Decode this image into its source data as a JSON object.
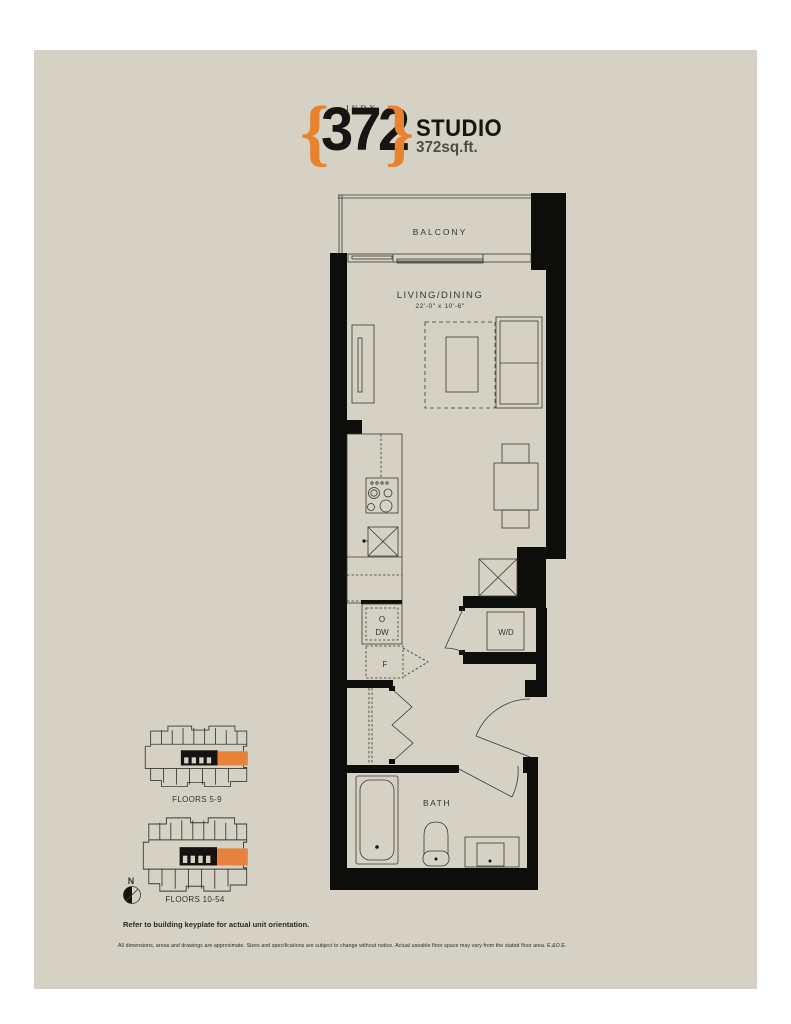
{
  "header": {
    "index_label": "INDX",
    "brace_left": "{",
    "brace_right": "}",
    "unit_number": "372",
    "unit_type": "STUDIO",
    "unit_area": "372sq.ft."
  },
  "floorplan": {
    "balcony_label": "BALCONY",
    "living_dining_label": "LIVING/DINING",
    "living_dining_dims": "22'-0\" x 10'-6\"",
    "oven_label": "O",
    "dishwasher_label": "DW",
    "fridge_label": "F",
    "washer_dryer_label": "W/D",
    "bath_label": "BATH"
  },
  "keyplates": {
    "plate1_label": "FLOORS 5-9",
    "plate2_label": "FLOORS 10-54",
    "north_label": "N"
  },
  "footer": {
    "orientation_note": "Refer to building keyplate for actual unit orientation.",
    "disclaimer": "All dimensions, areas and drawings are approximate. Sizes and specifications are subject to change without notice. Actual useable floor space may vary from the stated floor area. E.&O.E."
  },
  "colors": {
    "accent_orange": "#E8822F",
    "card_background": "#D5D2C5",
    "wall_black": "#0D0D0B"
  }
}
